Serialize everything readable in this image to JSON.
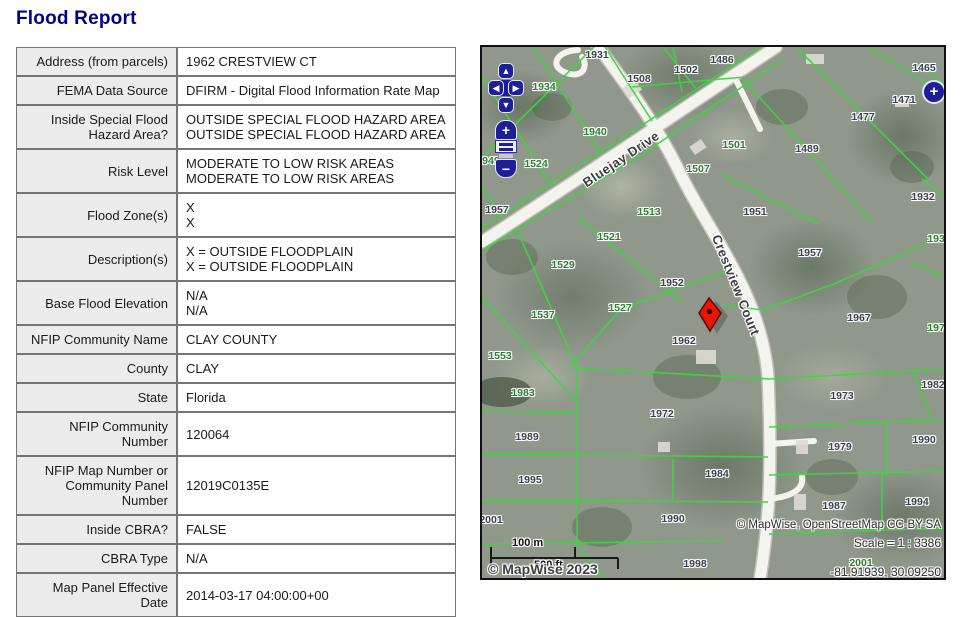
{
  "page": {
    "title": "Flood Report"
  },
  "report_table": {
    "rows": [
      {
        "label": "Address (from parcels)",
        "value": "1962 CRESTVIEW CT"
      },
      {
        "label": "FEMA Data Source",
        "value": "DFIRM - Digital Flood Information Rate Map"
      },
      {
        "label": "Inside Special Flood\nHazard Area?",
        "value": "OUTSIDE SPECIAL FLOOD HAZARD AREA\nOUTSIDE SPECIAL FLOOD HAZARD AREA"
      },
      {
        "label": "Risk Level",
        "value": "MODERATE TO LOW RISK AREAS\nMODERATE TO LOW RISK AREAS"
      },
      {
        "label": "Flood Zone(s)",
        "value": "X\nX"
      },
      {
        "label": "Description(s)",
        "value": "X = OUTSIDE FLOODPLAIN\nX = OUTSIDE FLOODPLAIN"
      },
      {
        "label": "Base Flood Elevation",
        "value": "N/A\nN/A"
      },
      {
        "label": "NFIP Community Name",
        "value": "CLAY COUNTY"
      },
      {
        "label": "County",
        "value": "CLAY"
      },
      {
        "label": "State",
        "value": "Florida"
      },
      {
        "label": "NFIP Community Number",
        "value": "120064"
      },
      {
        "label": "NFIP Map Number or\nCommunity Panel\nNumber",
        "value": "12019C0135E"
      },
      {
        "label": "Inside CBRA?",
        "value": "FALSE"
      },
      {
        "label": "CBRA Type",
        "value": "N/A"
      },
      {
        "label": "Map Panel Effective Date",
        "value": "2014-03-17 04:00:00+00"
      }
    ]
  },
  "map": {
    "roads": {
      "bluejay": "Bluejay Drive",
      "crestview": "Crestview Court"
    },
    "parcel_labels": [
      {
        "text": "1931",
        "x": 115,
        "y": 8,
        "color": "dark"
      },
      {
        "text": "1508",
        "x": 157,
        "y": 32,
        "color": "dark"
      },
      {
        "text": "1502",
        "x": 204,
        "y": 23,
        "color": "dark"
      },
      {
        "text": "1486",
        "x": 240,
        "y": 13,
        "color": "dark"
      },
      {
        "text": "1465",
        "x": 442,
        "y": 21,
        "color": "dark"
      },
      {
        "text": "1471",
        "x": 422,
        "y": 53,
        "color": "dark"
      },
      {
        "text": "1477",
        "x": 381,
        "y": 70,
        "color": "dark"
      },
      {
        "text": "1489",
        "x": 325,
        "y": 102,
        "color": "dark"
      },
      {
        "text": "1501",
        "x": 252,
        "y": 98,
        "color": "green"
      },
      {
        "text": "1507",
        "x": 216,
        "y": 122,
        "color": "green"
      },
      {
        "text": "1934",
        "x": 62,
        "y": 40,
        "color": "green"
      },
      {
        "text": "1940",
        "x": 113,
        "y": 85,
        "color": "green"
      },
      {
        "text": "1524",
        "x": 54,
        "y": 117,
        "color": "green"
      },
      {
        "text": "1949",
        "x": 6,
        "y": 114,
        "color": "green"
      },
      {
        "text": "1957",
        "x": 15,
        "y": 163,
        "color": "dark"
      },
      {
        "text": "1513",
        "x": 167,
        "y": 165,
        "color": "green"
      },
      {
        "text": "1951",
        "x": 273,
        "y": 165,
        "color": "dark"
      },
      {
        "text": "1932",
        "x": 441,
        "y": 150,
        "color": "dark"
      },
      {
        "text": "1521",
        "x": 127,
        "y": 190,
        "color": "green"
      },
      {
        "text": "1529",
        "x": 81,
        "y": 218,
        "color": "green"
      },
      {
        "text": "1952",
        "x": 190,
        "y": 236,
        "color": "dark"
      },
      {
        "text": "1957",
        "x": 328,
        "y": 206,
        "color": "dark"
      },
      {
        "text": "1938",
        "x": 457,
        "y": 192,
        "color": "green"
      },
      {
        "text": "1527",
        "x": 138,
        "y": 261,
        "color": "green"
      },
      {
        "text": "1537",
        "x": 61,
        "y": 268,
        "color": "green"
      },
      {
        "text": "1967",
        "x": 377,
        "y": 271,
        "color": "dark"
      },
      {
        "text": "1974",
        "x": 457,
        "y": 281,
        "color": "green"
      },
      {
        "text": "1962",
        "x": 202,
        "y": 294,
        "color": "dark"
      },
      {
        "text": "1553",
        "x": 18,
        "y": 309,
        "color": "green"
      },
      {
        "text": "1983",
        "x": 41,
        "y": 346,
        "color": "green"
      },
      {
        "text": "1982",
        "x": 451,
        "y": 338,
        "color": "dark"
      },
      {
        "text": "1973",
        "x": 360,
        "y": 349,
        "color": "dark"
      },
      {
        "text": "1972",
        "x": 180,
        "y": 367,
        "color": "dark"
      },
      {
        "text": "1989",
        "x": 45,
        "y": 390,
        "color": "dark"
      },
      {
        "text": "1990",
        "x": 442,
        "y": 393,
        "color": "dark"
      },
      {
        "text": "1979",
        "x": 358,
        "y": 400,
        "color": "dark"
      },
      {
        "text": "1995",
        "x": 48,
        "y": 433,
        "color": "dark"
      },
      {
        "text": "1984",
        "x": 235,
        "y": 427,
        "color": "dark"
      },
      {
        "text": "2001",
        "x": 9,
        "y": 473,
        "color": "dark"
      },
      {
        "text": "1990",
        "x": 191,
        "y": 472,
        "color": "dark"
      },
      {
        "text": "1987",
        "x": 352,
        "y": 459,
        "color": "dark"
      },
      {
        "text": "1994",
        "x": 435,
        "y": 455,
        "color": "dark"
      },
      {
        "text": "1998",
        "x": 213,
        "y": 517,
        "color": "dark"
      },
      {
        "text": "2001",
        "x": 379,
        "y": 516,
        "color": "green"
      }
    ],
    "controls": {
      "icons": {
        "pan_up": "▲",
        "pan_down": "▼",
        "pan_left": "◀",
        "pan_right": "▶",
        "zoom_in": "+",
        "zoom_out": "−",
        "expand": "+"
      }
    },
    "scale_bar": {
      "metric_label": "100 m",
      "imperial_label": "500 ft"
    },
    "attribution": {
      "copyright": "© MapWise 2023",
      "provider_line": "© MapWise, OpenStreetMap CC-BY-SA",
      "scale_text": "Scale = 1 : 3386",
      "coordinates": "-81.91939, 30.09250"
    },
    "colors": {
      "title_navy": "#00008B",
      "parcel_line_green": "#3ed63e",
      "control_navy": "#1e1e96",
      "marker_red": "#e81508",
      "label_green": "#2e7d32",
      "label_dark": "#39414d"
    }
  }
}
